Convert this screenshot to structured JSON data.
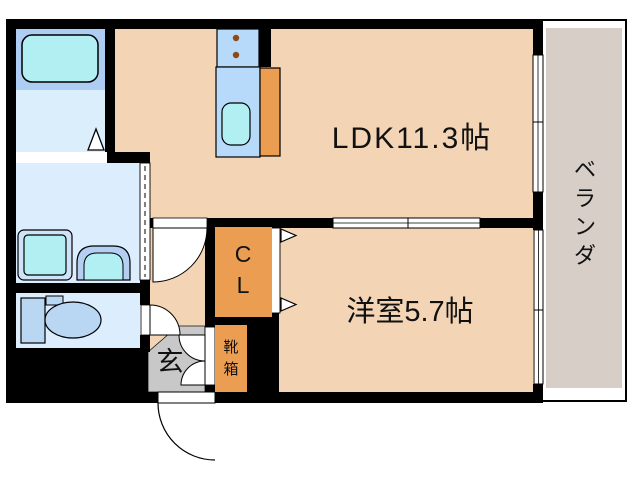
{
  "floor_plan": {
    "ldk": {
      "label": "LDK11.3帖"
    },
    "western_room": {
      "label": "洋室5.7帖"
    },
    "veranda": {
      "chars": [
        "ベ",
        "ラ",
        "ン",
        "ダ"
      ]
    },
    "closet": {
      "chars": [
        "C",
        "L"
      ]
    },
    "entrance": {
      "label": "玄"
    },
    "shoe_box": {
      "chars": [
        "靴",
        "箱"
      ]
    },
    "colors": {
      "floor_wood": "#f3d5b5",
      "veranda_floor": "#d6cec7",
      "entrance_floor": "#c8c8c8",
      "cabinet_orange": "#eb9d52",
      "fixture_blue": "#b9d6f2",
      "unit_blue": "#b8dafa",
      "tub_zone_blue": "#adcdf2",
      "water_cyan": "#b2eff2",
      "bath_floor_blue": "#daeefc",
      "wet_floor_blue": "#dceefd",
      "pan_rim_blue": "#cfe3f8",
      "vanity_blue": "#b4cff2",
      "burner_brown": "#8a4a1a",
      "wall_black": "#000000"
    }
  }
}
